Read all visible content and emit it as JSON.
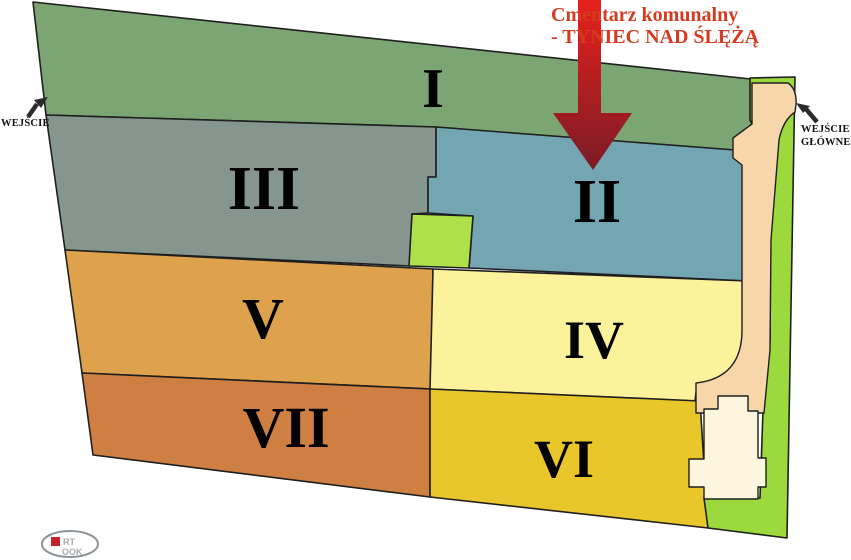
{
  "title": {
    "line1": "Cmentarz komunalny",
    "line2": "- TYNIEC NAD ŚLĘŻĄ",
    "color": "#d43b20"
  },
  "entrances": {
    "left": {
      "label": "WEJŚCIE"
    },
    "main": {
      "line1": "WEJŚCIE",
      "line2": "GŁÓWNE"
    }
  },
  "sections": [
    {
      "numeral": "I",
      "color": "#7ba572"
    },
    {
      "numeral": "II",
      "color": "#74a5b3"
    },
    {
      "numeral": "III",
      "color": "#85968f"
    },
    {
      "numeral": "IV",
      "color": "#fbf29b"
    },
    {
      "numeral": "V",
      "color": "#dfa24c"
    },
    {
      "numeral": "VI",
      "color": "#e9c72b"
    },
    {
      "numeral": "VII",
      "color": "#ce7f41"
    }
  ],
  "features": {
    "lawn_color": "#9bd93c",
    "small_green_square_color": "#aee04a",
    "path_color": "#f7d6a9",
    "chapel_color": "#fbf6dd",
    "outline_color": "#1f1f1f",
    "pointer_arrow_top_color": "#e7211d",
    "pointer_arrow_bottom_color": "#7c1b25",
    "entrance_arrow_color": "#2b2b2b"
  },
  "logo": {
    "top": "RT",
    "bottom": "OOK"
  }
}
